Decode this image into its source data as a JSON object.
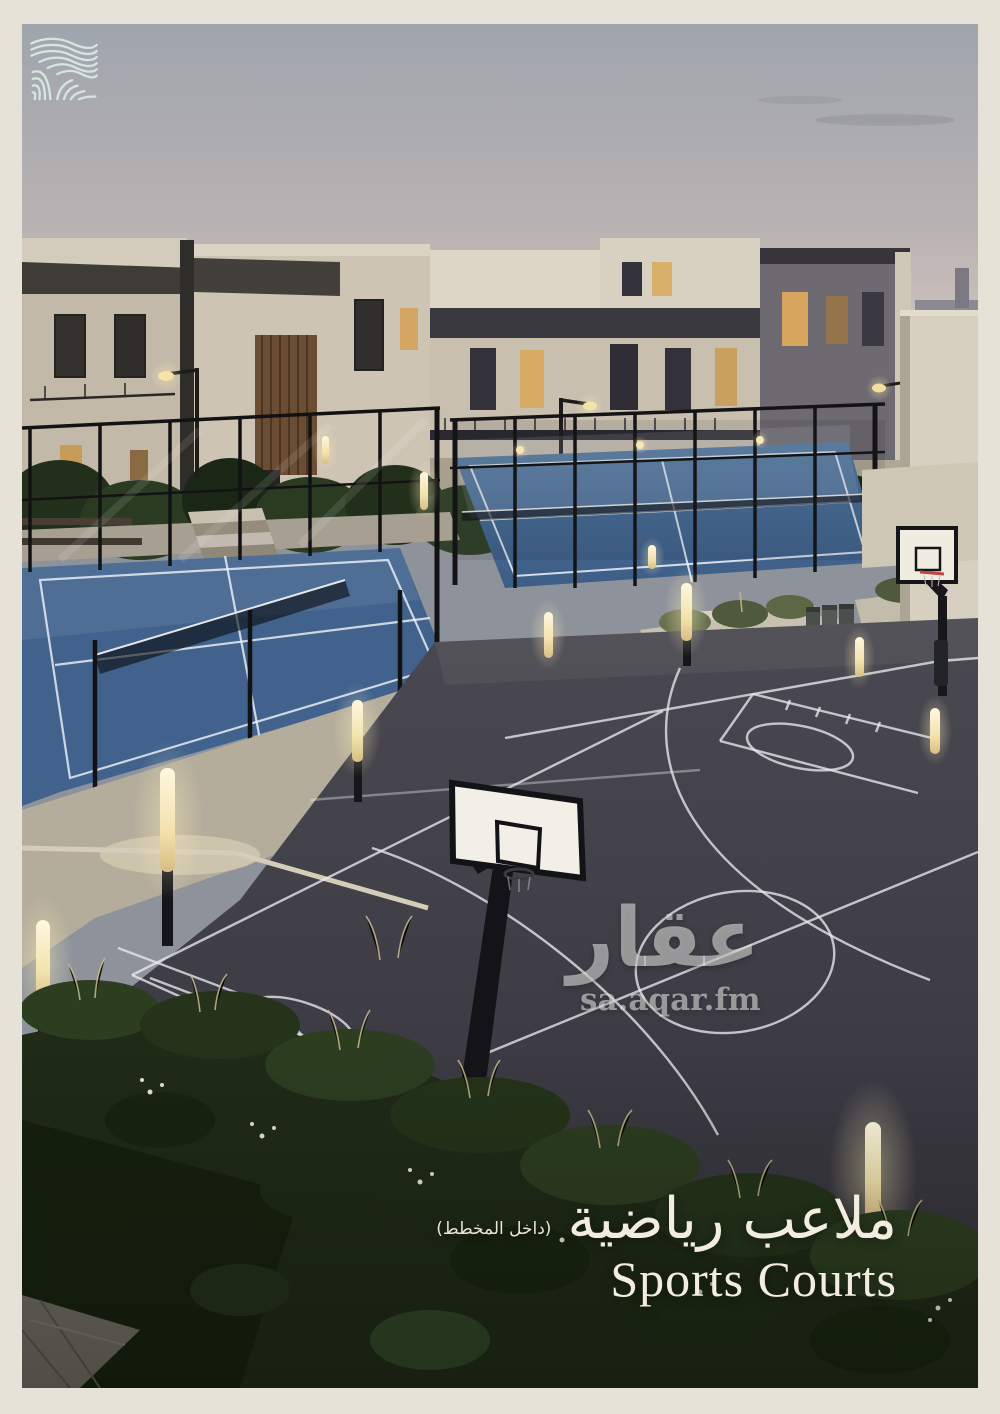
{
  "colors": {
    "frame": "#e7e2d7",
    "sky_top": "#9fa5ad",
    "sky_horizon": "#decfc4",
    "building_cream": "#d6cfc0",
    "court_blue": "#4d79a6",
    "court_blue_near": "#40628c",
    "court_surface_dark": "#3d3c44",
    "line_white": "#e9e9ec",
    "foliage_dark": "#24301c",
    "light_warm": "#f7e9bd",
    "text_cream": "#f2ede0",
    "watermark_gray": "rgba(236,236,234,0.55)"
  },
  "icons": {
    "logo": "waves-logo-icon",
    "scene_items": [
      "padel-courts",
      "basketball-court",
      "basketball-hoop",
      "bollard-lights",
      "villas"
    ]
  },
  "watermark": {
    "brand_ar": "عقار",
    "site": "sa.aqar.fm"
  },
  "caption": {
    "title_ar": "ملاعب رياضية",
    "note_ar": "(داخل المخطط)",
    "title_en": "Sports Courts"
  }
}
